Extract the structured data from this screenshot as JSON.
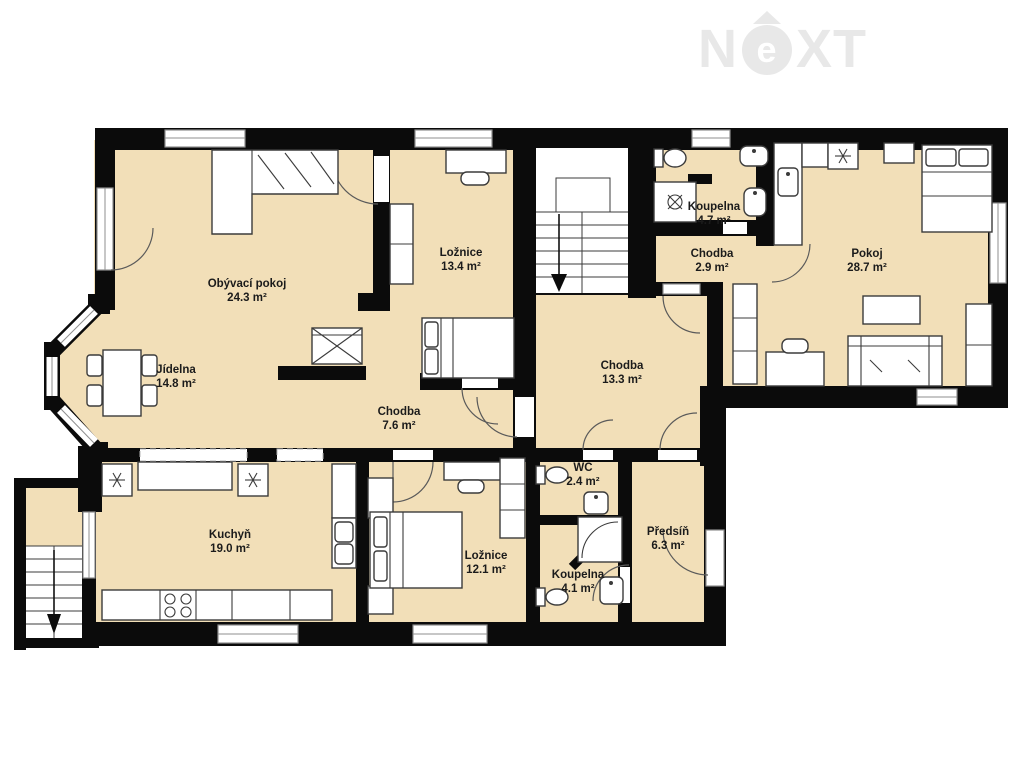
{
  "watermark": {
    "n": "N",
    "e": "e",
    "xt": "XT"
  },
  "rooms": {
    "obyvaci": {
      "name": "Obývací pokoj",
      "area": "24.3 m²"
    },
    "jidelna": {
      "name": "Jídelna",
      "area": "14.8 m²"
    },
    "loznice1": {
      "name": "Ložnice",
      "area": "13.4 m²"
    },
    "chodba76": {
      "name": "Chodba",
      "area": "7.6 m²"
    },
    "kuchyn": {
      "name": "Kuchyň",
      "area": "19.0 m²"
    },
    "loznice2": {
      "name": "Ložnice",
      "area": "12.1 m²"
    },
    "wc": {
      "name": "WC",
      "area": "2.4 m²"
    },
    "koupelna41": {
      "name": "Koupelna",
      "area": "4.1 m²"
    },
    "predsin": {
      "name": "Předsíň",
      "area": "6.3 m²"
    },
    "chodba133": {
      "name": "Chodba",
      "area": "13.3 m²"
    },
    "koupelna47": {
      "name": "Koupelna",
      "area": "4.7 m²"
    },
    "chodba29": {
      "name": "Chodba",
      "area": "2.9 m²"
    },
    "pokoj": {
      "name": "Pokoj",
      "area": "28.7 m²"
    }
  },
  "colors": {
    "floor": "#f2dfb8",
    "wall": "#0b0b0b",
    "watermark": "#e8e8e8",
    "label": "#1b1b1b"
  }
}
